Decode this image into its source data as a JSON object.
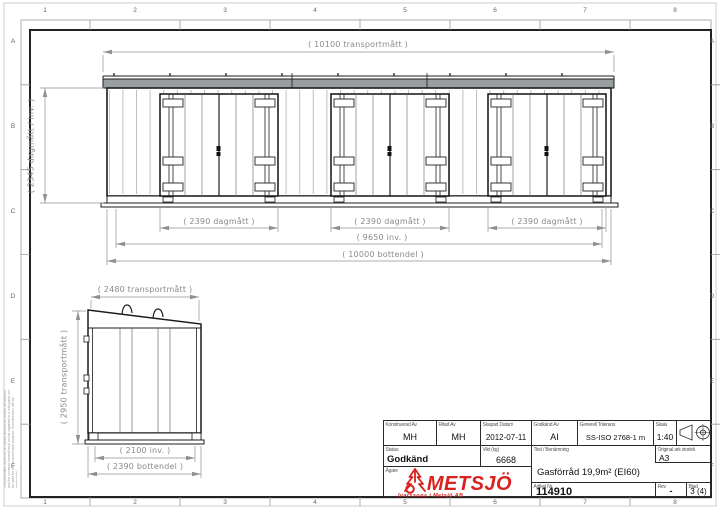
{
  "sheet": {
    "grid_columns": [
      "1",
      "2",
      "3",
      "4",
      "5",
      "6",
      "7",
      "8"
    ],
    "grid_rows": [
      "A",
      "B",
      "C",
      "D",
      "E",
      "F"
    ],
    "disclaimer": "This document must not be copied without our written permission, and the contents thereof must not be imparted to a third party nor be used for any unauthorized purpose. Contravention will be prosecuted."
  },
  "front_view": {
    "dim_transport": "( 10100 transportmått )",
    "dim_height": "( 2345 dagmått / inv. )",
    "dim_door_1": "( 2390 dagmått )",
    "dim_door_2": "( 2390 dagmått )",
    "dim_door_3": "( 2390 dagmått )",
    "dim_inner": "( 9650 inv. )",
    "dim_bottom": "( 10000 bottendel )"
  },
  "side_view": {
    "dim_transport_width": "( 2480 transportmått )",
    "dim_transport_height": "( 2950 transportmått )",
    "dim_inner": "( 2100 inv. )",
    "dim_bottom": "( 2390 bottendel )"
  },
  "title_block": {
    "konstruerad": {
      "label": "Konstruerad Av",
      "value": "MH"
    },
    "ritad": {
      "label": "Ritad Av",
      "value": "MH"
    },
    "skapad": {
      "label": "Skapad Datum",
      "value": "2012-07-11"
    },
    "godkand_av": {
      "label": "Godkänd Av",
      "value": "AI"
    },
    "tolerans": {
      "label": "Generell Tolerans",
      "value": "SS-ISO 2768-1 m"
    },
    "skala": {
      "label": "Skala",
      "value": "1:40"
    },
    "status": {
      "label": "Status",
      "value": "Godkänd"
    },
    "vikt": {
      "label": "Vikt (kg)",
      "value": "6668"
    },
    "agare": {
      "label": "Ägare"
    },
    "titel": {
      "label": "Titel / Benämning",
      "value": "Gasförråd 19,9m² (EI60)"
    },
    "original": {
      "label": "Original ark storlek",
      "value": "A3"
    },
    "artikel": {
      "label": "Artikel Nr",
      "value": "114910"
    },
    "rev": {
      "label": "Rev",
      "value": "-"
    },
    "blad": {
      "label": "Blad",
      "value": "3 (4)"
    }
  },
  "logo": {
    "name": "METSJÖ",
    "subtitle": "Ivarssons i Metsjö AB",
    "color": "#d8231f",
    "icon": "spruce-tree-logo-icon"
  },
  "symbols": {
    "projection": "first-angle-projection-icon"
  }
}
